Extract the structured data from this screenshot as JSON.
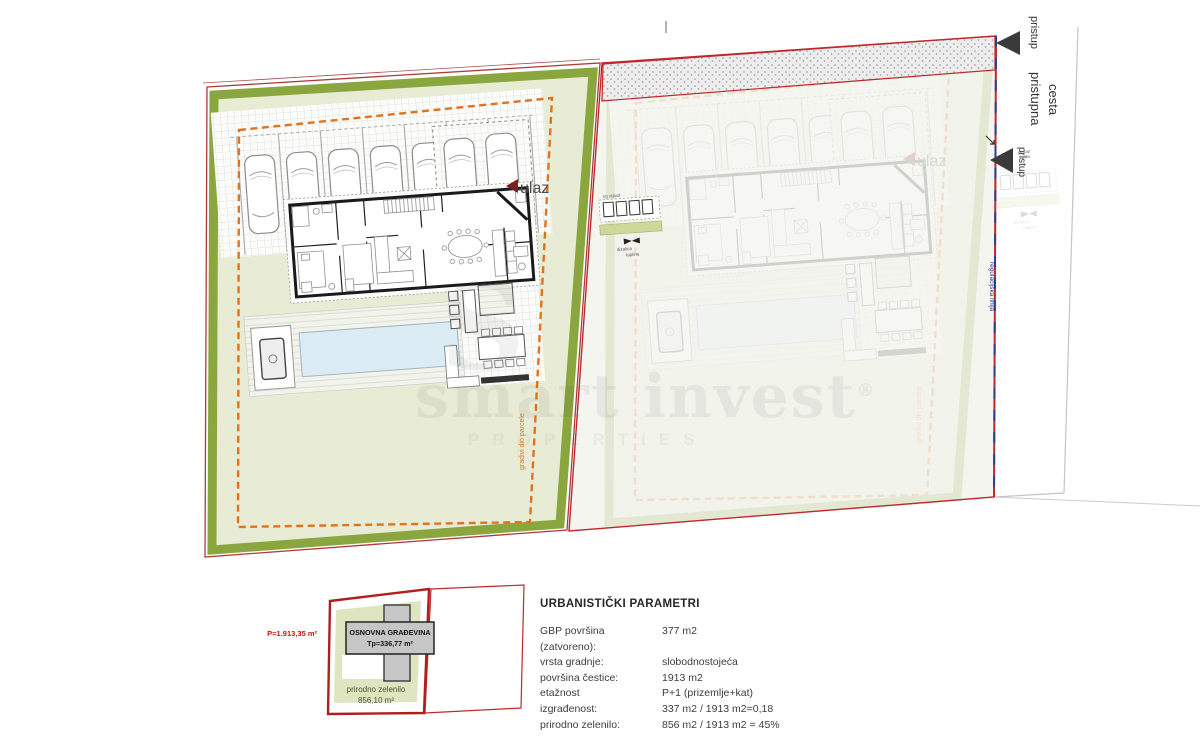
{
  "plan": {
    "left": {
      "ulaz": "ulaz",
      "waste": "ng otpad",
      "heatpump1": "dizalica",
      "heatpump2": "topline",
      "setback": "gradivi dio parcele"
    },
    "right": {
      "regulation": "regulacijska linija"
    },
    "road": {
      "name1": "pristupna",
      "name2": "cesta",
      "access_top": "pristup",
      "access_mid": "pristup",
      "access_small1": "pristup",
      "access_small2": "cesta"
    }
  },
  "watermark": {
    "monogram": "S",
    "name": "smart invest",
    "registered": "®",
    "subtitle": "PROPERTIES"
  },
  "legend": {
    "parcel_area": "P=1.913,35 m²",
    "building_title": "OSNOVNA GRAĐEVINA",
    "building_area": "Tp=336,77 m²",
    "green_line1": "prirodno zelenilo",
    "green_line2": "856,10 m²"
  },
  "parameters": {
    "title": "URBANISTIČKI PARAMETRI",
    "rows": [
      {
        "label": "GBP površina (zatvoreno):",
        "value": "377 m2"
      },
      {
        "label": "vrsta gradnje:",
        "value": "slobodnostojeća"
      },
      {
        "label": "površina čestice:",
        "value": "1913 m2"
      },
      {
        "label": "etažnost",
        "value": "P+1 (prizemlje+kat)"
      },
      {
        "label": "izgrađenost:",
        "value": "337 m2 / 1913 m2=0,18"
      },
      {
        "label": "prirodno zelenilo:",
        "value": "856 m2 / 1913 m2 = 45%"
      }
    ]
  },
  "colors": {
    "boundary_red": "#c0282d",
    "green_band": "#8aa63e",
    "pale_green": "#e8ecd5",
    "setback_orange": "#e2731d",
    "regulation_blue": "#2a3f8f",
    "pool_blue": "#dcecf5",
    "building_gray": "#c6c6c6"
  }
}
